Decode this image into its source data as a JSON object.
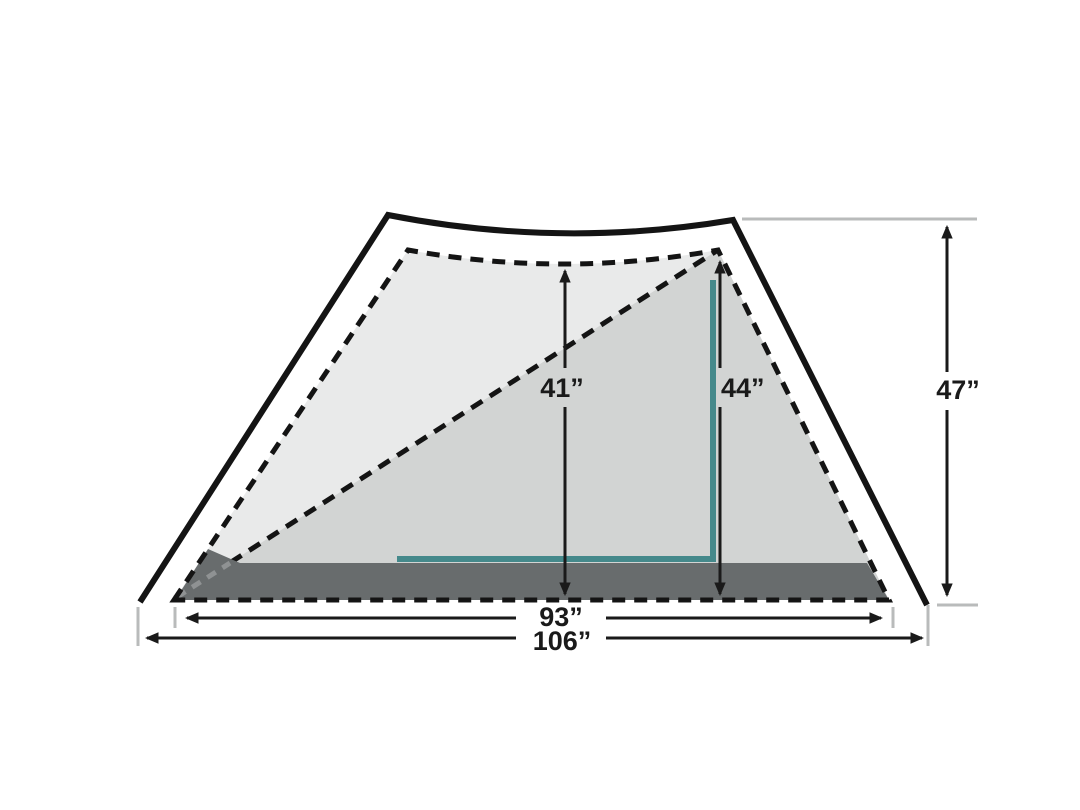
{
  "diagram": {
    "name": "Tent cross-section with dimension callouts",
    "labels": {
      "interior_peak_height": "41”",
      "wall_peak_height": "44”",
      "exterior_height": "47”",
      "interior_width": "93”",
      "exterior_width": "106”"
    },
    "colors": {
      "outline_black": "#141414",
      "inner_light_fill": "#e9eaea",
      "mid_gray_fill": "#d2d4d3",
      "floor_dark_fill": "#686c6d",
      "floor_overlay_dash_gray": "#8f9293",
      "accent_teal": "#45898b",
      "guide_gray": "#b9bbbb",
      "dimension_black": "#1a1a1a",
      "background": "#ffffff"
    }
  }
}
